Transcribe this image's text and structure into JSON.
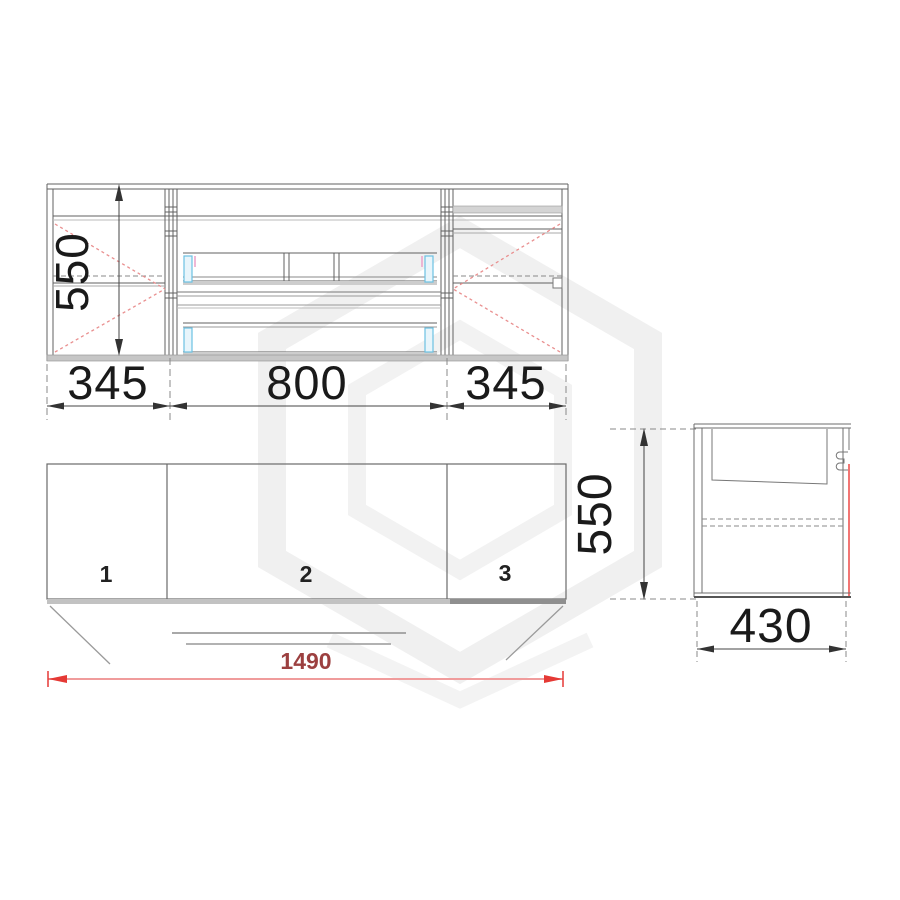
{
  "top_view": {
    "height_label": "550",
    "width_labels": [
      "345",
      "800",
      "345"
    ]
  },
  "front_view": {
    "door_labels": [
      "1",
      "2",
      "3"
    ],
    "overall_width_label": "1490"
  },
  "side_view": {
    "height_label": "550",
    "depth_label": "430"
  },
  "colors": {
    "drawing_line": "#616161",
    "dim_text": "#1a1a1a",
    "red_dim_line": "#f09c9c",
    "red_dim_arrow": "#e53935",
    "red_dim_text": "#9c4040",
    "door_swing_dash": "#e98f8f",
    "drawer_runner_cyan": "#6cc0e2",
    "drawer_runner_pink": "#eba6cc",
    "shadow_band": "#c6c6c6",
    "watermark": "#f0f0f0"
  }
}
